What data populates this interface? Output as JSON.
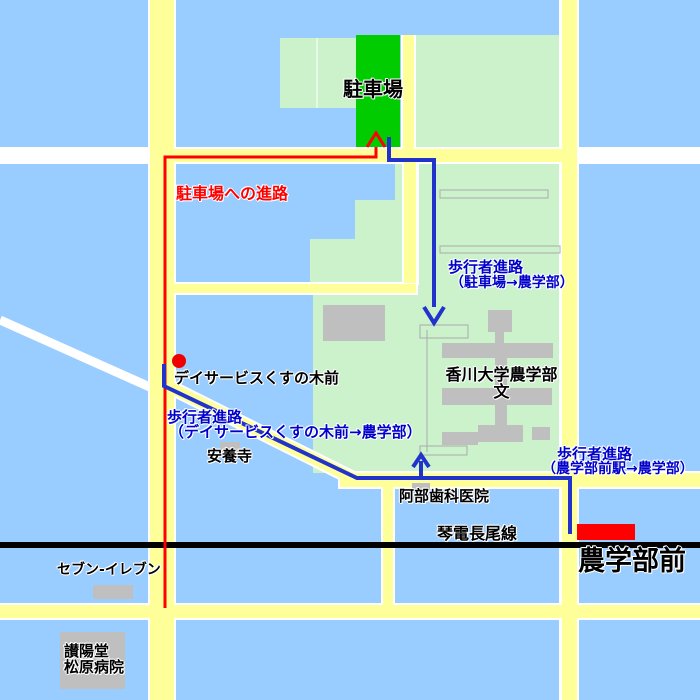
{
  "map_title": "香川大学農学部 案内図",
  "labels": {
    "parking": "駐車場",
    "route_to_parking": "駐車場への進路",
    "walk_parking_1": "歩行者進路",
    "walk_parking_2": "（駐車場→農学部）",
    "university_1": "香川大学農学部",
    "university_2": "文",
    "day_service": "デイサービスくすの木前",
    "walk_dayservice_1": "歩行者進路",
    "walk_dayservice_2": "（デイサービスくすの木前→農学部）",
    "anyoji": "安養寺",
    "abe_dental": "阿部歯科医院",
    "walk_station_1": "歩行者進路",
    "walk_station_2": "（農学部前駅→農学部）",
    "railway": "琴電長尾線",
    "station": "農学部前",
    "seven_eleven": "セブン-イレブン",
    "hospital_1": "讃陽堂",
    "hospital_2": "松原病院"
  },
  "routes": [
    {
      "name": "car-route-to-parking",
      "color": "#FF0000",
      "label": "駐車場への進路"
    },
    {
      "name": "walk-route-parking-to-agri",
      "color": "#2233CC",
      "label": "歩行者進路（駐車場→農学部）"
    },
    {
      "name": "walk-route-dayservice-to-agri",
      "color": "#2233CC",
      "label": "歩行者進路（デイサービスくすの木前→農学部）"
    },
    {
      "name": "walk-route-station-to-agri",
      "color": "#2233CC",
      "label": "歩行者進路（農学部前駅→農学部）"
    }
  ],
  "colors": {
    "background": "#99CCFF",
    "road_yellow": "#FFFF99",
    "road_white": "#FFFFFF",
    "campus_green": "#CCF2CC",
    "parking_green": "#00CC00",
    "building_gray": "#BFBFBF",
    "railway_black": "#000000",
    "route_red": "#FF0000",
    "route_blue": "#2233CC",
    "station_marker_red": "#FF0000",
    "label_blue": "#0000CC"
  },
  "markers": {
    "station_marker": "農学部前駅ホーム",
    "day_service_stop_dot": "デイサービスくすの木前 地点"
  }
}
